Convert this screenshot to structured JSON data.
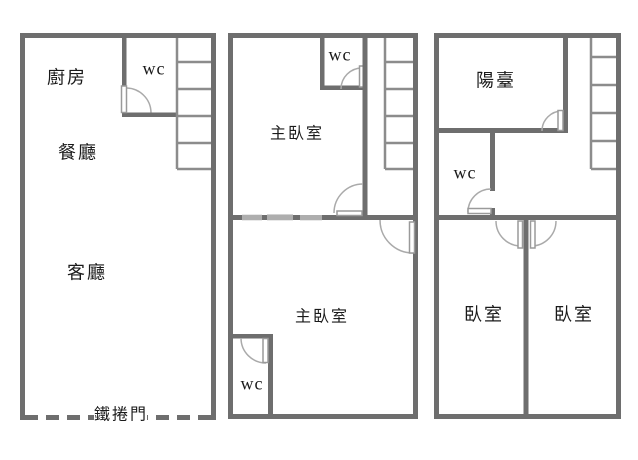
{
  "colors": {
    "wall": "#6e6e6e",
    "stair_line": "#8c8c8c",
    "door_arc": "#aaaaaa",
    "door_leaf_border": "#9a9a9a",
    "text": "#1a1a1a",
    "background": "#ffffff"
  },
  "floor_plan": {
    "floors": [
      {
        "id": "floor-1",
        "rooms": {
          "kitchen": "廚房",
          "wc": "wc",
          "dining": "餐廳",
          "living": "客廳"
        },
        "shutter_door": "鐵捲門",
        "stair_steps": 5
      },
      {
        "id": "floor-2",
        "rooms": {
          "wc_top": "wc",
          "master_top": "主臥室",
          "master_bottom": "主臥室",
          "wc_bottom": "wc"
        },
        "stair_steps": 5
      },
      {
        "id": "floor-3",
        "rooms": {
          "balcony": "陽臺",
          "wc": "wc",
          "bedroom_left": "臥室",
          "bedroom_right": "臥室"
        },
        "stair_steps": 5
      }
    ]
  }
}
